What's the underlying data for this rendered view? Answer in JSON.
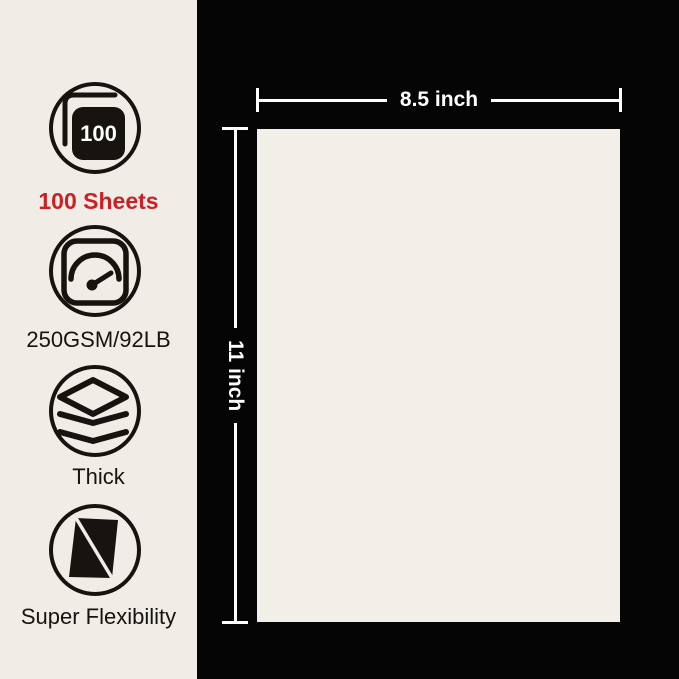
{
  "colors": {
    "panel_bg": "#EFEDE6",
    "canvas_bg": "#050505",
    "paper": "#F1EFE8",
    "accent_red": "#CD2026",
    "ink": "#17140F",
    "dimension_line": "#FFFFFF"
  },
  "features": [
    {
      "icon": "sheet-count-icon",
      "badge": "100",
      "label": "100 Sheets"
    },
    {
      "icon": "gauge-icon",
      "label": "250GSM/92LB"
    },
    {
      "icon": "layers-icon",
      "label": "Thick"
    },
    {
      "icon": "bent-sheet-icon",
      "label": "Super Flexibility"
    }
  ],
  "dimensions": {
    "width_label": "8.5 inch",
    "height_label": "11 inch"
  }
}
